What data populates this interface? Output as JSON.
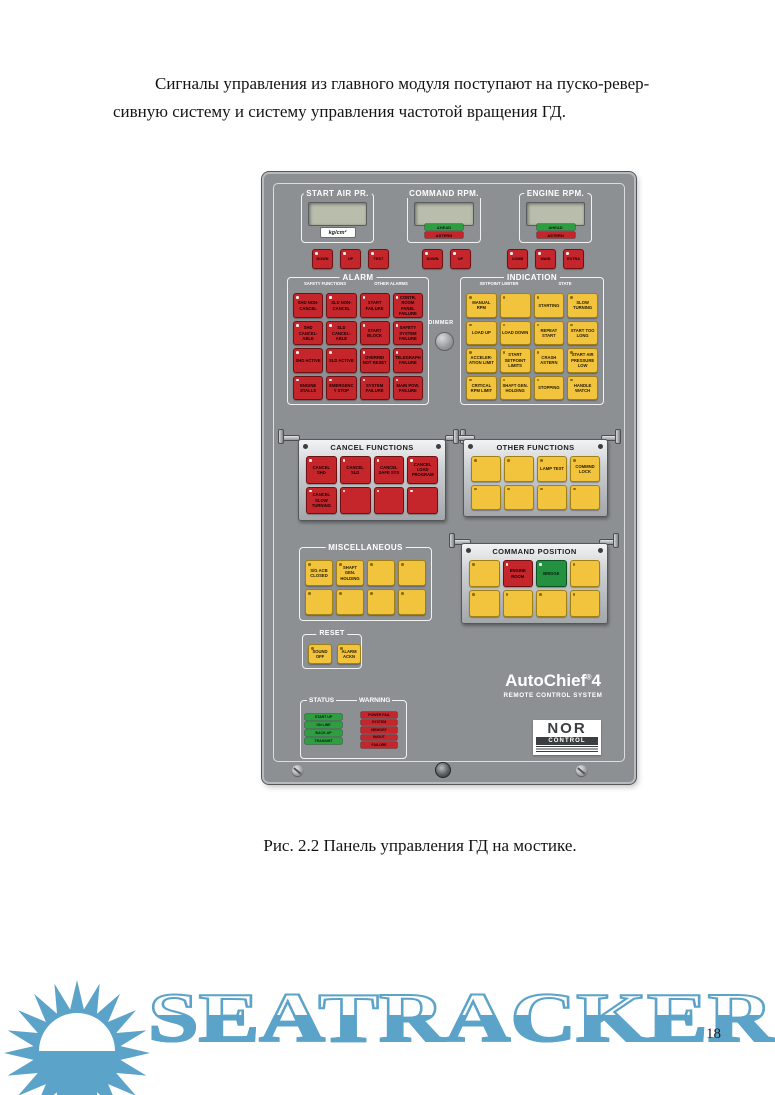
{
  "document": {
    "paragraph_line1": "Сигналы управления из главного модуля поступают на пуско-ревер-",
    "paragraph_line2": "сивную систему и систему управления частотой вращения ГД.",
    "caption": "Рис. 2.2  Панель управления ГД на мостике.",
    "page_number": "18"
  },
  "watermark": {
    "text": "SEATRACKER.RU",
    "logo": "sun-logo",
    "color": "#5ba3c9"
  },
  "colors": {
    "panel_gray": "#8d9093",
    "button_red": "#c5262c",
    "button_yellow": "#f2c43d",
    "button_green": "#23913f",
    "lcd_green": "#b9bdab",
    "watermark_blue": "#5ba3c9"
  },
  "top": {
    "groups": [
      {
        "label": "START AIR PR.",
        "unit": "kg/cm²",
        "buttons": [
          "DOWN",
          "UP",
          "TEST"
        ]
      },
      {
        "label": "COMMAND RPM.",
        "indicators": [
          "AHEAD",
          "ASTERN"
        ],
        "buttons": [
          "DOWN",
          "UP"
        ]
      },
      {
        "label": "ENGINE RPM.",
        "indicators": [
          "AHEAD",
          "ASTERN"
        ],
        "buttons": [
          "COMB",
          "MAIN",
          "EXTRA"
        ]
      }
    ]
  },
  "dimmer": {
    "label": "DIMMER"
  },
  "alarm": {
    "title": "ALARM",
    "sub_left": "SAFETY FUNCTIONS",
    "sub_right": "OTHER ALARMS",
    "buttons": [
      "SHD NON-CANCEL",
      "SLD NON-CANCEL",
      "START FAILURE",
      "CONTR. ROOM PANEL FAILURE",
      "SHD CANCEL-ABLE",
      "SLD CANCEL-ABLE",
      "START BLOCK",
      "SAFETY SYSTEM FAILURE",
      "SHD ACTIVE",
      "SLD ACTIVE",
      "OVERRID NOT RESET",
      "TELEGRAPH FAILURE",
      "ENGINE STALLS",
      "EMERGENCY STOP",
      "SYSTEM FAILURE",
      "MAIN POW. FAILURE"
    ]
  },
  "indication": {
    "title": "INDICATION",
    "sub_left": "SETPOINT LIMITER",
    "sub_right": "STATE",
    "buttons": [
      "MANUAL RPM",
      "",
      "STARTING",
      "SLOW TURNING",
      "LOAD UP",
      "LOAD DOWN",
      "REPEAT START",
      "START TOO LONG",
      "ACCELER- ATION LIMIT",
      "START SETPOINT LIMITS",
      "CRASH ASTERN",
      "START AIR PRESSURE LOW",
      "CRITICAL RPM LIMIT",
      "SHAFT GEN. HOLDING",
      "STOPPING",
      "HANDLE WATCH"
    ]
  },
  "cancel": {
    "title": "CANCEL FUNCTIONS",
    "buttons": [
      "CANCEL SHD",
      "CANCEL SLD",
      "CANCEL SAFE SYS",
      "CANCEL LOAD PROGRAM",
      "CANCEL SLOW TURNING",
      "",
      "",
      ""
    ]
  },
  "other": {
    "title": "OTHER FUNCTIONS",
    "buttons": [
      "",
      "",
      "LAMP TEST",
      "COMMND LOCK",
      "",
      "",
      "",
      ""
    ]
  },
  "misc": {
    "title": "MISCELLANEOUS",
    "buttons": [
      "S/G ACB CLOSED",
      "SHAFT GEN. HOLDING",
      "",
      "",
      "",
      "",
      "",
      ""
    ]
  },
  "command_position": {
    "title": "COMMAND POSITION",
    "buttons": [
      {
        "label": "",
        "color": "yellow"
      },
      {
        "label": "ENGINE ROOM",
        "color": "red"
      },
      {
        "label": "BRIDGE",
        "color": "green"
      },
      {
        "label": "",
        "color": "yellow"
      },
      {
        "label": "",
        "color": "yellow"
      },
      {
        "label": "",
        "color": "yellow"
      },
      {
        "label": "",
        "color": "yellow"
      },
      {
        "label": "",
        "color": "yellow"
      }
    ]
  },
  "reset": {
    "title": "RESET",
    "buttons": [
      "SOUND OFF",
      "ALARM ACKN"
    ]
  },
  "status": {
    "title": "STATUS",
    "items": [
      "START UP",
      "ON LINE",
      "BACK-UP",
      "TRANSMIT"
    ]
  },
  "warning": {
    "title": "WARNING",
    "items": [
      "POWER FAIL",
      "SYSTEM",
      "MEMORY",
      "IN/OUT",
      "FAILURE"
    ]
  },
  "branding": {
    "product": "AutoChief",
    "reg": "®",
    "version": "4",
    "subtitle": "REMOTE CONTROL SYSTEM",
    "maker_top": "NOR",
    "maker_bottom": "CONTROL"
  }
}
